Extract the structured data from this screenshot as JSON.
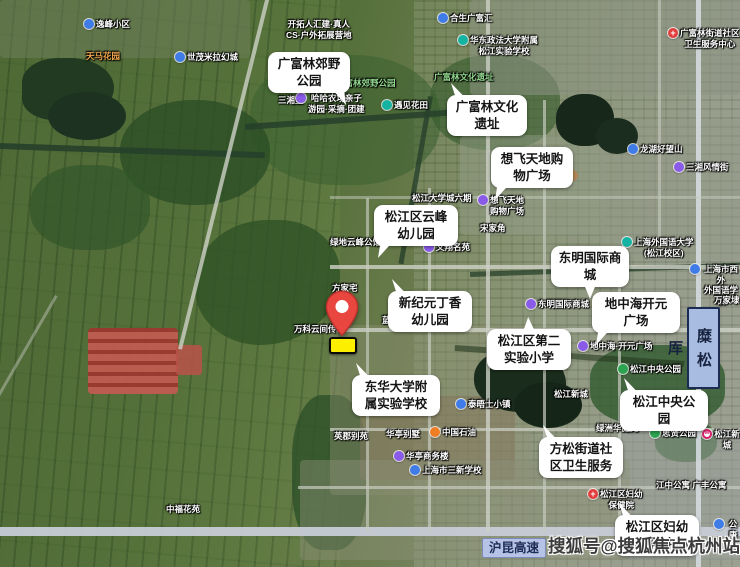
{
  "map": {
    "callouts": [
      {
        "lines": [
          "广富林郊野",
          "公园"
        ],
        "x": 268,
        "y": 52,
        "w": 82,
        "tail": "br"
      },
      {
        "lines": [
          "广富林文化",
          "遗址"
        ],
        "x": 447,
        "y": 95,
        "w": 80,
        "tail": "tl"
      },
      {
        "lines": [
          "想飞天地购",
          "物广场"
        ],
        "x": 491,
        "y": 147,
        "w": 82,
        "tail": "bl"
      },
      {
        "lines": [
          "松江区云峰",
          "幼儿园"
        ],
        "x": 374,
        "y": 205,
        "w": 84,
        "tail": "bl"
      },
      {
        "lines": [
          "东明国际商",
          "城"
        ],
        "x": 551,
        "y": 246,
        "w": 78,
        "tail": "b"
      },
      {
        "lines": [
          "新纪元丁香",
          "幼儿园"
        ],
        "x": 388,
        "y": 291,
        "w": 84,
        "tail": "tl"
      },
      {
        "lines": [
          "地中海开元",
          "广场"
        ],
        "x": 592,
        "y": 292,
        "w": 88,
        "tail": "bl"
      },
      {
        "lines": [
          "松江区第二",
          "实验小学"
        ],
        "x": 487,
        "y": 329,
        "w": 84,
        "tail": "t"
      },
      {
        "lines": [
          "东华大学附",
          "属实验学校"
        ],
        "x": 352,
        "y": 375,
        "w": 88,
        "tail": "tl"
      },
      {
        "lines": [
          "松江中央公",
          "园"
        ],
        "x": 620,
        "y": 390,
        "w": 88,
        "tail": "tl"
      },
      {
        "lines": [
          "方松街道社",
          "区卫生服务"
        ],
        "x": 539,
        "y": 437,
        "w": 84,
        "tail": "tl"
      },
      {
        "lines": [
          "松江区妇幼",
          "保健院中心"
        ],
        "x": 615,
        "y": 515,
        "w": 84,
        "tail": "tl"
      }
    ],
    "pois": [
      {
        "t": "逸峰小区",
        "x": 84,
        "y": 19,
        "icon": "blue"
      },
      {
        "t": "开拓人汇建·真人\nCS·户外拓展营地",
        "x": 286,
        "y": 19
      },
      {
        "t": "合生广富汇",
        "x": 438,
        "y": 13,
        "icon": "blue"
      },
      {
        "t": "华东政法大学附属\n松江实验学校",
        "x": 458,
        "y": 35,
        "icon": "teal"
      },
      {
        "t": "广富林街道社区\n卫生服务中心",
        "x": 668,
        "y": 28,
        "icon": "redcross"
      },
      {
        "t": "天马花园",
        "x": 86,
        "y": 51,
        "cls": "orange"
      },
      {
        "t": "世茂米拉幻城",
        "x": 175,
        "y": 52,
        "icon": "blue"
      },
      {
        "t": "三湘里",
        "x": 278,
        "y": 95
      },
      {
        "t": "广富林郊野公园",
        "x": 336,
        "y": 78,
        "cls": "green"
      },
      {
        "t": "哈哈农场亲子\n游园·采摘·团建",
        "x": 296,
        "y": 93,
        "icon": "purple"
      },
      {
        "t": "遇见花田",
        "x": 382,
        "y": 100,
        "icon": "teal"
      },
      {
        "t": "广富林文化遗址",
        "x": 434,
        "y": 72,
        "cls": "green"
      },
      {
        "t": "龙湖好望山",
        "x": 628,
        "y": 144,
        "icon": "blue"
      },
      {
        "t": "三湘风情街",
        "x": 674,
        "y": 162,
        "icon": "purple"
      },
      {
        "t": "松江大学城六期",
        "x": 412,
        "y": 193
      },
      {
        "t": "想飞天地\n购物广场",
        "x": 478,
        "y": 195,
        "icon": "purple"
      },
      {
        "t": "宋家角",
        "x": 480,
        "y": 223
      },
      {
        "t": "上海外国语大学\n(松江校区)",
        "x": 622,
        "y": 237,
        "icon": "teal"
      },
      {
        "t": "上海市西外\n外国语学校",
        "x": 690,
        "y": 264,
        "icon": "blue"
      },
      {
        "t": "文翔名苑",
        "x": 424,
        "y": 242,
        "icon": "purple"
      },
      {
        "t": "绿地云峰公馆",
        "x": 330,
        "y": 237
      },
      {
        "t": "方家宅",
        "x": 332,
        "y": 283
      },
      {
        "t": "万科云间传",
        "x": 294,
        "y": 324
      },
      {
        "t": "蓝色剑桥",
        "x": 382,
        "y": 315
      },
      {
        "t": "万家埭",
        "x": 714,
        "y": 295
      },
      {
        "t": "东明国际商城",
        "x": 526,
        "y": 299,
        "icon": "purple"
      },
      {
        "t": "地中海·开元广场",
        "x": 578,
        "y": 341,
        "icon": "purple"
      },
      {
        "t": "松江中央公园",
        "x": 618,
        "y": 364,
        "icon": "green"
      },
      {
        "t": "松江新城",
        "x": 554,
        "y": 389
      },
      {
        "t": "泰晤士小镇",
        "x": 456,
        "y": 399,
        "icon": "blue"
      },
      {
        "t": "英郡别苑",
        "x": 334,
        "y": 431
      },
      {
        "t": "华亭别墅",
        "x": 386,
        "y": 429
      },
      {
        "t": "中国石油",
        "x": 430,
        "y": 427,
        "icon": "orange"
      },
      {
        "t": "华亭商务楼",
        "x": 394,
        "y": 451,
        "icon": "purple"
      },
      {
        "t": "上海市三新学校",
        "x": 410,
        "y": 465,
        "icon": "blue"
      },
      {
        "t": "思贤公园",
        "x": 650,
        "y": 428,
        "icon": "green"
      },
      {
        "t": "松江新城",
        "x": 702,
        "y": 429,
        "icon": "metro"
      },
      {
        "t": "绿洲华庭苑",
        "x": 596,
        "y": 423
      },
      {
        "t": "松江区妇幼\n保健院",
        "x": 588,
        "y": 489,
        "icon": "redcross"
      },
      {
        "t": "江中公寓 广丰公寓",
        "x": 656,
        "y": 480
      },
      {
        "t": "公康苑",
        "x": 714,
        "y": 519,
        "icon": "blue"
      },
      {
        "t": "中福花苑",
        "x": 166,
        "y": 504
      }
    ],
    "road_sign": {
      "text": "沪昆高速"
    },
    "vertical_sign": {
      "text": "糜松厍"
    },
    "watermark": {
      "text": "搜狐号@搜狐焦点杭州站"
    },
    "colors": {
      "callout_bg": "#ffffff",
      "site_fill": "#fcf000",
      "pin_red": "#e8463f",
      "sign_bg": "#b6c3e6",
      "sign_text": "#1f2c55"
    }
  }
}
